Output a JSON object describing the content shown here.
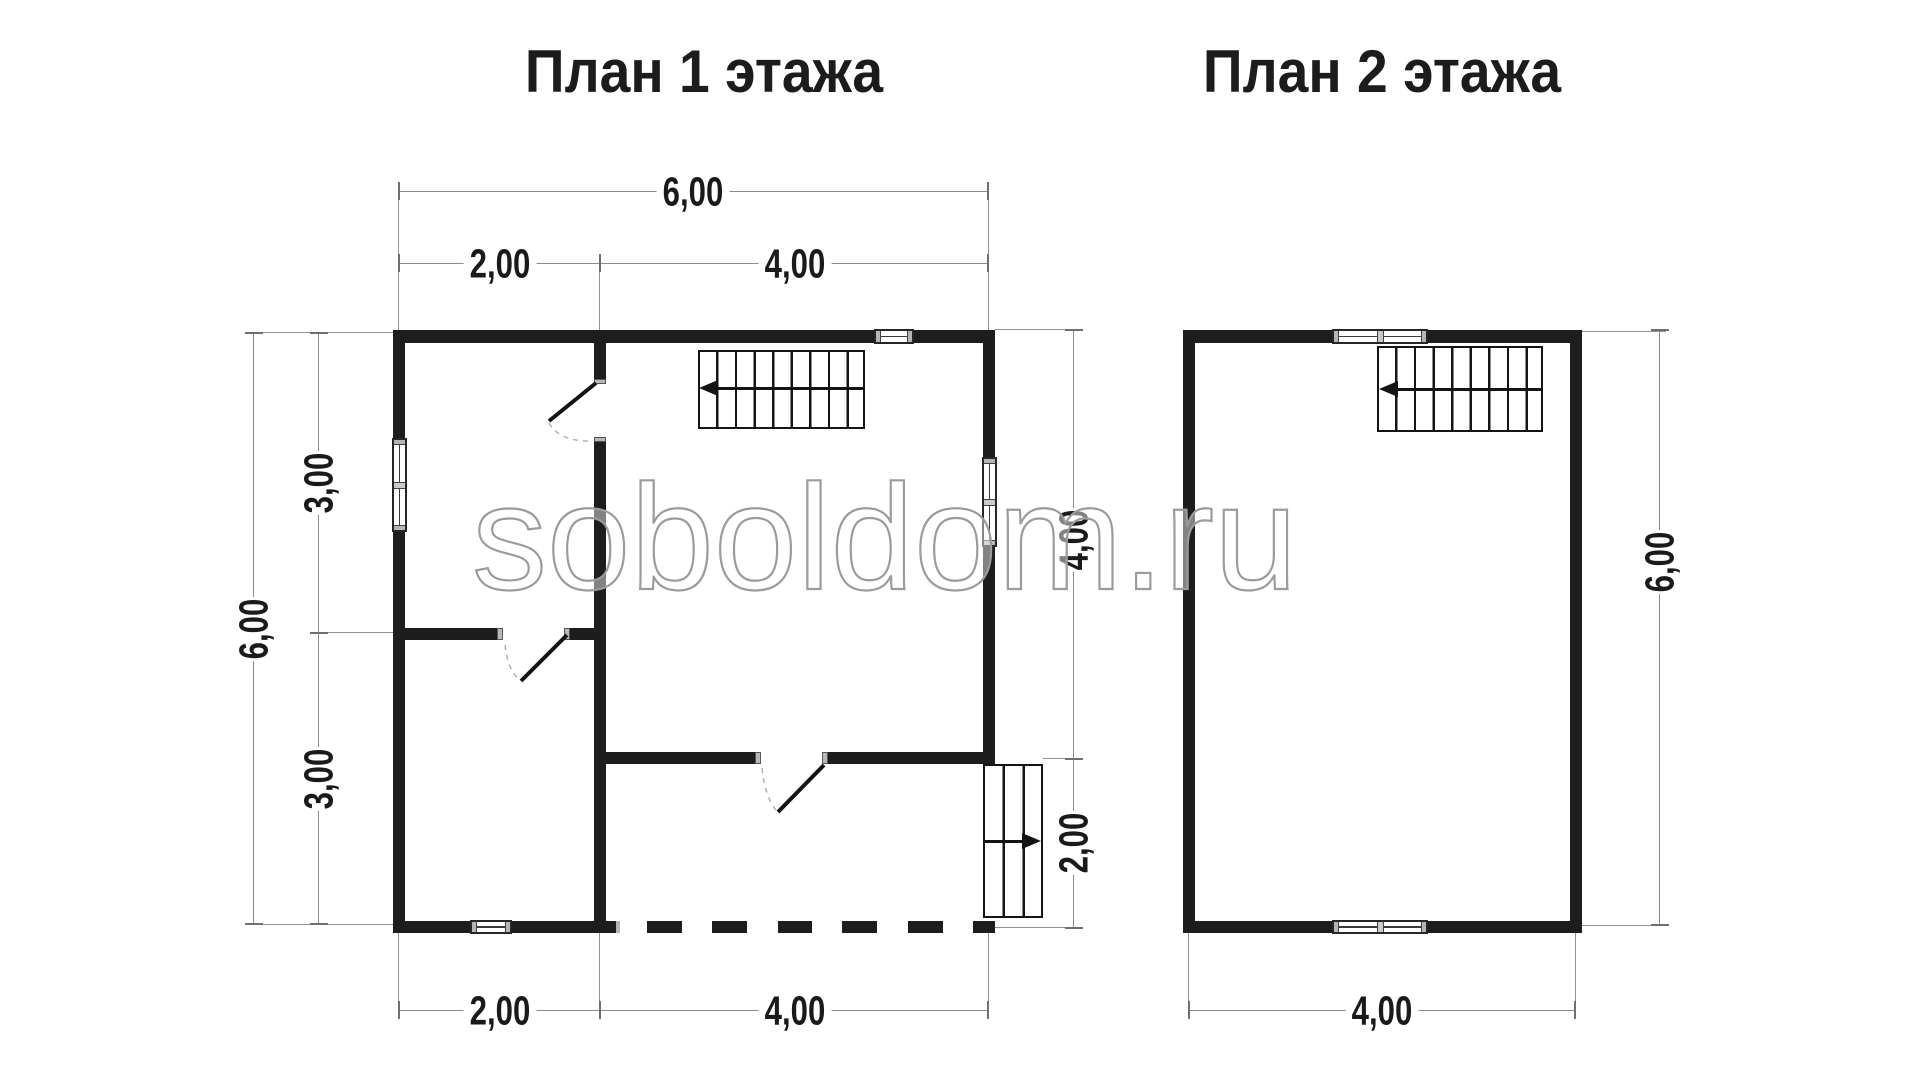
{
  "titles": {
    "plan1": "План 1 этажа",
    "plan2": "План 2 этажа"
  },
  "watermark": "soboldom.ru",
  "dims": {
    "plan1": {
      "top_total": "6,00",
      "top_left": "2,00",
      "top_right": "4,00",
      "left_total": "6,00",
      "left_upper": "3,00",
      "left_lower": "3,00",
      "right_upper": "4,00",
      "right_lower": "2,00",
      "bottom_left": "2,00",
      "bottom_right": "4,00"
    },
    "plan2": {
      "bottom": "4,00",
      "right": "6,00"
    }
  }
}
